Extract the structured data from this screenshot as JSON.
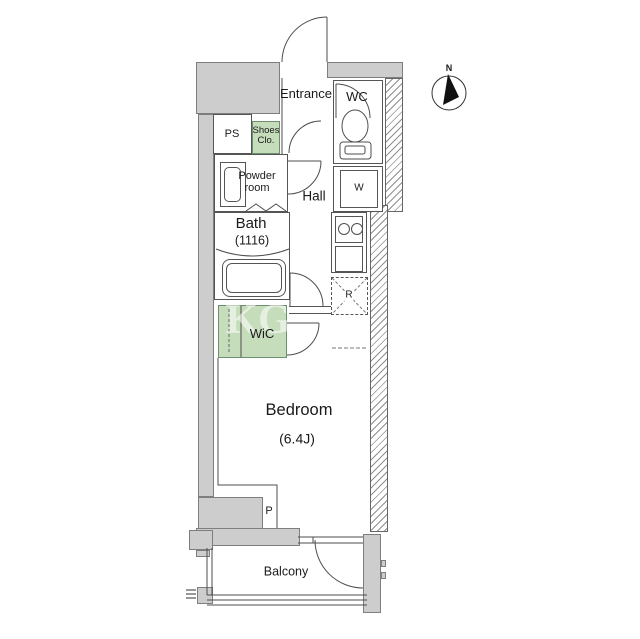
{
  "floor_plan": {
    "labels": {
      "entrance": "Entrance",
      "wc": "WC",
      "ps": "PS",
      "shoes_closet_line1": "Shoes",
      "shoes_closet_line2": "Clo.",
      "powder_room_line1": "Powder",
      "powder_room_line2": "room",
      "hall": "Hall",
      "bath": "Bath",
      "bath_size": "(1116)",
      "washing_machine": "W",
      "refrigerator": "R",
      "wic": "WiC",
      "bedroom": "Bedroom",
      "bedroom_size": "(6.4J)",
      "pillar": "P",
      "balcony": "Balcony",
      "compass_north": "N",
      "watermark": "KG"
    },
    "colors": {
      "wall_fill": "#cdcdcd",
      "closet_fill": "#c6ddbc",
      "line": "#555555"
    }
  }
}
